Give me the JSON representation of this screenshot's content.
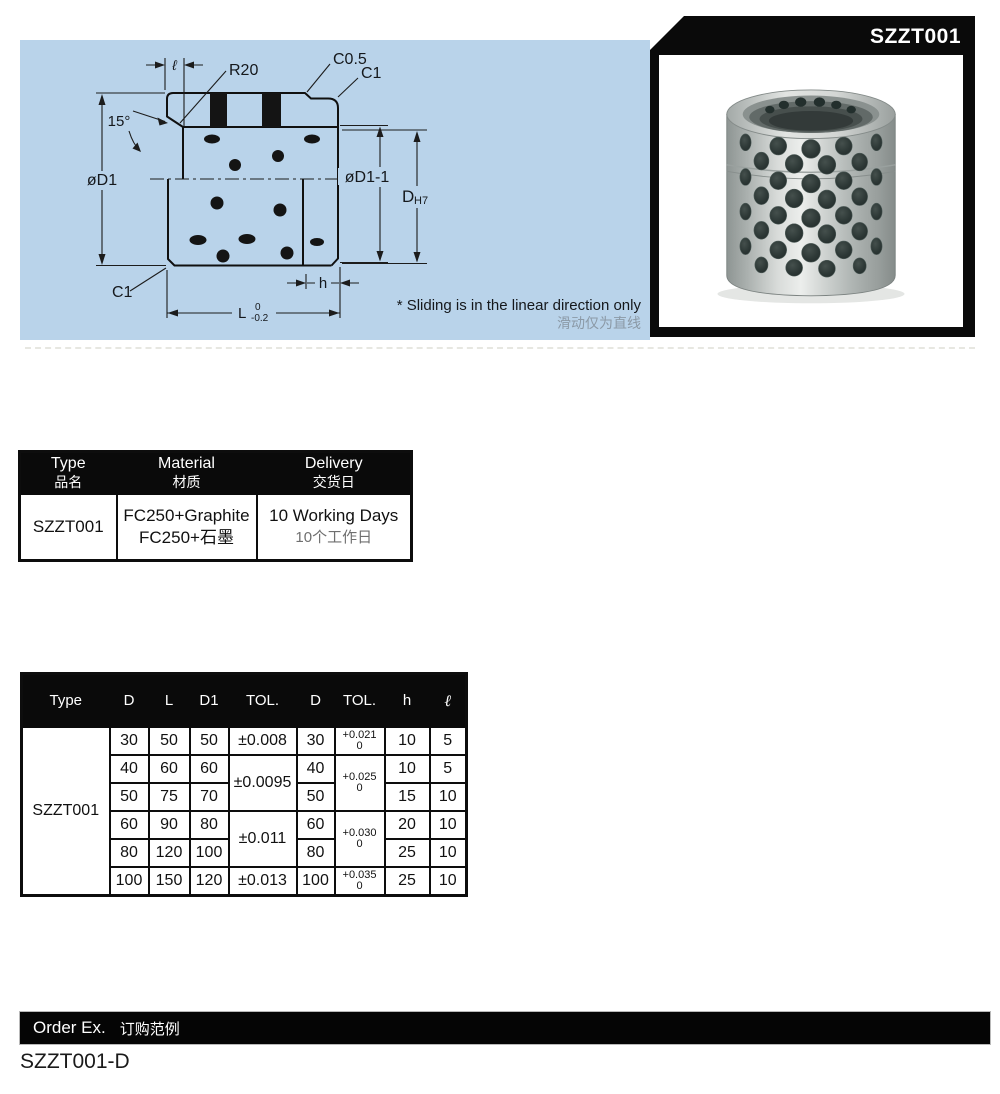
{
  "page": {
    "order_example_value": "SZZT001-D"
  },
  "photo_panel": {
    "title": "SZZT001"
  },
  "drawing": {
    "labels": {
      "ell": "ℓ",
      "r20": "R20",
      "c05": "C0.5",
      "c1_top": "C1",
      "angle": "15°",
      "d1": "øD1",
      "d1_1": "øD1-1",
      "d_main": "D",
      "d_sub": "H7",
      "c1_bottom": "C1",
      "h": "h",
      "L": "L",
      "L_tol_upper": "0",
      "L_tol_lower": "-0.2"
    },
    "note_en": "* Sliding is in the linear direction only",
    "note_cn": "滑动仅为直线"
  },
  "info_table": {
    "headers": [
      {
        "en": "Type",
        "cn": "品名"
      },
      {
        "en": "Material",
        "cn": "材质"
      },
      {
        "en": "Delivery",
        "cn": "交货日"
      }
    ],
    "row": {
      "type": "SZZT001",
      "material_en": "FC250+Graphite",
      "material_cn": "FC250+石墨",
      "delivery_en": "10 Working Days",
      "delivery_cn": "10个工作日"
    }
  },
  "spec_table": {
    "headers": [
      "Type",
      "D",
      "L",
      "D1",
      "TOL.",
      "D",
      "TOL.",
      "h",
      "ℓ"
    ],
    "type_value": "SZZT001",
    "rows": [
      {
        "d": "30",
        "l": "50",
        "d1": "50",
        "tol1": "±0.008",
        "d2": "30",
        "tol2_hi": "+0.021",
        "tol2_lo": "0",
        "h": "10",
        "ell": "5"
      },
      {
        "d": "40",
        "l": "60",
        "d1": "60",
        "tol1": "±0.0095",
        "d2": "40",
        "tol2_hi": "+0.025",
        "tol2_lo": "0",
        "h": "10",
        "ell": "5"
      },
      {
        "d": "50",
        "l": "75",
        "d1": "70",
        "d2": "50",
        "h": "15",
        "ell": "10"
      },
      {
        "d": "60",
        "l": "90",
        "d1": "80",
        "tol1": "±0.011",
        "d2": "60",
        "tol2_hi": "+0.030",
        "tol2_lo": "0",
        "h": "20",
        "ell": "10"
      },
      {
        "d": "80",
        "l": "120",
        "d1": "100",
        "d2": "80",
        "h": "25",
        "ell": "10"
      },
      {
        "d": "100",
        "l": "150",
        "d1": "120",
        "tol1": "±0.013",
        "d2": "100",
        "tol2_hi": "+0.035",
        "tol2_lo": "0",
        "h": "25",
        "ell": "10"
      }
    ]
  },
  "order_bar": {
    "label_en": "Order Ex.",
    "label_cn": "订购范例"
  },
  "colors": {
    "blueprint_bg": "#b9d3ea",
    "header_bg": "#0a0a0a",
    "note_cn_color": "#8b99a6"
  }
}
